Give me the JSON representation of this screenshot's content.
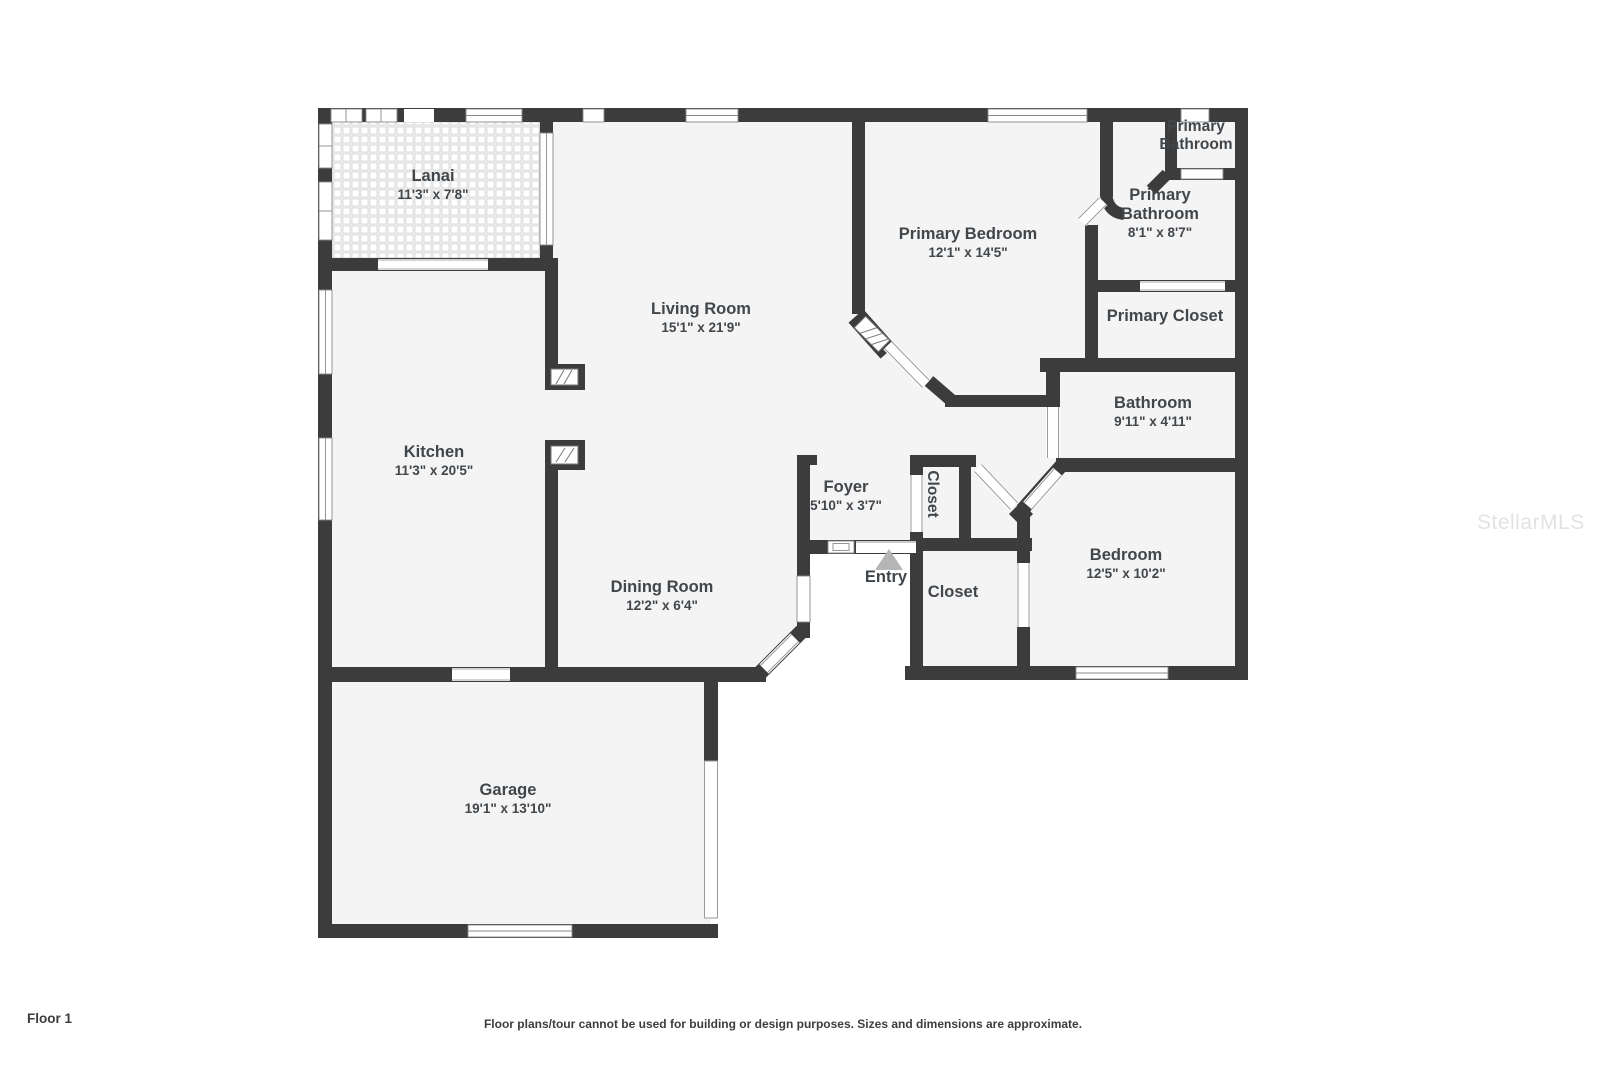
{
  "floor_label": "Floor 1",
  "disclaimer": "Floor plans/tour cannot be used for building or design purposes. Sizes and dimensions are approximate.",
  "watermark": "StellarMLS",
  "colors": {
    "wall": "#3c3c3c",
    "room_fill": "#f4f4f4",
    "label_text": "#41464b",
    "entry_arrow": "#b5b5b5",
    "watermark": "#d9d9d9"
  },
  "rooms": [
    {
      "id": "lanai",
      "name": "Lanai",
      "dims": "11'3\" x 7'8\""
    },
    {
      "id": "living-room",
      "name": "Living Room",
      "dims": "15'1\" x 21'9\""
    },
    {
      "id": "primary-bedroom",
      "name": "Primary Bedroom",
      "dims": "12'1\" x 14'5\""
    },
    {
      "id": "primary-bathroom-wc",
      "name": "Primary Bathroom",
      "dims": ""
    },
    {
      "id": "primary-bathroom",
      "name": "Primary Bathroom",
      "dims": "8'1\" x 8'7\""
    },
    {
      "id": "primary-closet",
      "name": "Primary Closet",
      "dims": ""
    },
    {
      "id": "bathroom",
      "name": "Bathroom",
      "dims": "9'11\" x 4'11\""
    },
    {
      "id": "kitchen",
      "name": "Kitchen",
      "dims": "11'3\" x 20'5\""
    },
    {
      "id": "foyer",
      "name": "Foyer",
      "dims": "5'10\" x 3'7\""
    },
    {
      "id": "closet-hall",
      "name": "Closet",
      "dims": ""
    },
    {
      "id": "entry",
      "name": "Entry",
      "dims": ""
    },
    {
      "id": "dining-room",
      "name": "Dining Room",
      "dims": "12'2\" x 6'4\""
    },
    {
      "id": "closet-bedroom",
      "name": "Closet",
      "dims": ""
    },
    {
      "id": "bedroom",
      "name": "Bedroom",
      "dims": "12'5\" x 10'2\""
    },
    {
      "id": "garage",
      "name": "Garage",
      "dims": "19'1\" x 13'10\""
    }
  ]
}
